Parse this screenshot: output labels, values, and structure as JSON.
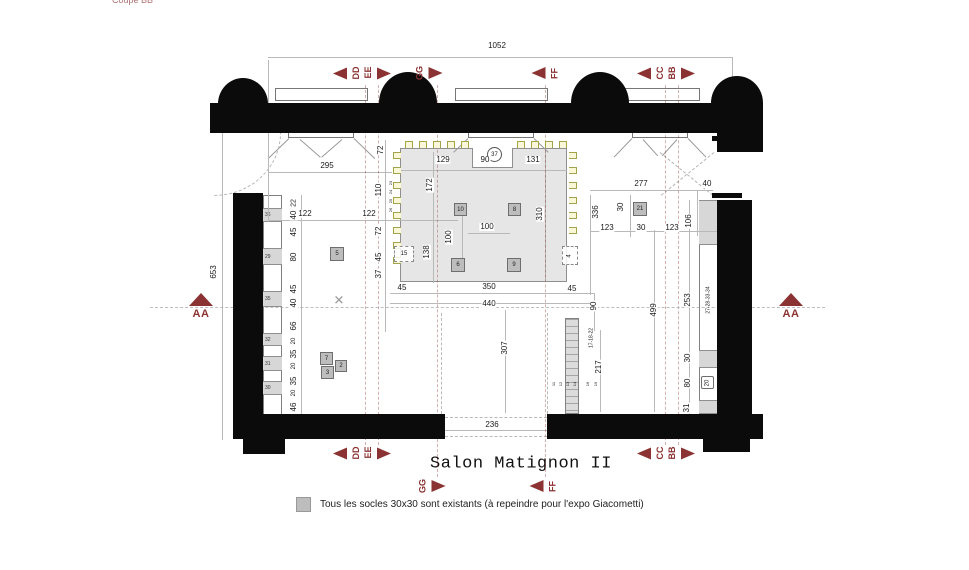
{
  "title": "Salon Matignon II",
  "header": {
    "cut_text": "Coupe BB"
  },
  "legend": {
    "swatch_color": "#bdbdbd",
    "text": "Tous les socles 30x30 sont existants (à repeindre pour l'expo Giacometti)"
  },
  "colors": {
    "marker_red": "#8b3232",
    "wall": "#0b0b0b",
    "platform": "#e6e6e6",
    "pedestal": "#bdbdbd",
    "chair": "#a3a34a"
  },
  "sections": [
    {
      "texts": [
        "DD",
        "EE"
      ],
      "x": 362,
      "y": 73,
      "left": true,
      "right": true
    },
    {
      "texts": [
        "GG"
      ],
      "x": 428,
      "y": 73,
      "left": false,
      "right": true
    },
    {
      "texts": [
        "FF"
      ],
      "x": 546,
      "y": 73,
      "left": true,
      "right": false
    },
    {
      "texts": [
        "CC",
        "BB"
      ],
      "x": 666,
      "y": 73,
      "left": true,
      "right": true
    },
    {
      "texts": [
        "DD",
        "EE"
      ],
      "x": 362,
      "y": 453,
      "left": true,
      "right": true
    },
    {
      "texts": [
        "CC",
        "BB"
      ],
      "x": 666,
      "y": 453,
      "left": true,
      "right": true
    },
    {
      "texts": [
        "GG"
      ],
      "x": 431,
      "y": 486,
      "left": false,
      "right": true
    },
    {
      "texts": [
        "FF"
      ],
      "x": 544,
      "y": 486,
      "left": true,
      "right": false
    }
  ],
  "aa_markers": [
    {
      "label": "AA",
      "x": 201,
      "y": 293
    },
    {
      "label": "AA",
      "x": 791,
      "y": 293
    }
  ],
  "circle_labels": [
    {
      "n": "37",
      "x": 494,
      "y": 154
    }
  ],
  "boxes": [
    {
      "n": "10",
      "x": 454,
      "y": 203,
      "s": 13
    },
    {
      "n": "8",
      "x": 508,
      "y": 203,
      "s": 13
    },
    {
      "n": "6",
      "x": 451,
      "y": 258,
      "s": 14
    },
    {
      "n": "9",
      "x": 507,
      "y": 258,
      "s": 14
    },
    {
      "n": "5",
      "x": 330,
      "y": 247,
      "s": 14
    },
    {
      "n": "21",
      "x": 633,
      "y": 202,
      "s": 14
    },
    {
      "n": "7",
      "x": 320,
      "y": 352,
      "s": 13
    },
    {
      "n": "2",
      "x": 335,
      "y": 360,
      "s": 12
    },
    {
      "n": "3",
      "x": 321,
      "y": 366,
      "s": 13
    },
    {
      "n": "20",
      "x": 701,
      "y": 376,
      "s": 13,
      "white": true,
      "rot": true
    }
  ],
  "dashed_boxes": [
    {
      "n": "15",
      "x": 394,
      "y": 246,
      "w": 20,
      "h": 16
    },
    {
      "n": "4",
      "x": 562,
      "y": 246,
      "w": 16,
      "h": 19,
      "rot": true
    }
  ],
  "strip_left": {
    "x": 263,
    "y": 195,
    "w": 19,
    "h": 221,
    "segments": [
      {
        "n": "36",
        "y": 208,
        "h": 14
      },
      {
        "n": "29",
        "y": 248,
        "h": 17
      },
      {
        "n": "35",
        "y": 291,
        "h": 16
      },
      {
        "n": "32",
        "y": 333,
        "h": 13
      },
      {
        "n": "31",
        "y": 356,
        "h": 15
      },
      {
        "n": "30",
        "y": 381,
        "h": 14
      }
    ]
  },
  "strip_right": {
    "x": 699,
    "y": 200,
    "w": 19,
    "h": 215,
    "segments": [
      {
        "n": "",
        "y": 200,
        "h": 45
      },
      {
        "n": "",
        "y": 350,
        "h": 18
      },
      {
        "n": "",
        "y": 400,
        "h": 14
      }
    ]
  },
  "strip_bottom": {
    "x": 565,
    "y": 318,
    "w": 14,
    "h": 96
  },
  "chairs": [
    {
      "x": 405,
      "y": 141,
      "o": "d"
    },
    {
      "x": 419,
      "y": 141,
      "o": "d"
    },
    {
      "x": 433,
      "y": 141,
      "o": "d"
    },
    {
      "x": 447,
      "y": 141,
      "o": "d"
    },
    {
      "x": 461,
      "y": 141,
      "o": "d"
    },
    {
      "x": 517,
      "y": 141,
      "o": "d"
    },
    {
      "x": 531,
      "y": 141,
      "o": "d"
    },
    {
      "x": 545,
      "y": 141,
      "o": "d"
    },
    {
      "x": 559,
      "y": 141,
      "o": "d"
    },
    {
      "x": 393,
      "y": 152,
      "o": "r"
    },
    {
      "x": 393,
      "y": 167,
      "o": "r"
    },
    {
      "x": 393,
      "y": 182,
      "o": "r"
    },
    {
      "x": 393,
      "y": 197,
      "o": "r"
    },
    {
      "x": 393,
      "y": 212,
      "o": "r"
    },
    {
      "x": 393,
      "y": 227,
      "o": "r"
    },
    {
      "x": 393,
      "y": 242,
      "o": "r"
    },
    {
      "x": 393,
      "y": 257,
      "o": "r"
    },
    {
      "x": 569,
      "y": 152,
      "o": "l"
    },
    {
      "x": 569,
      "y": 167,
      "o": "l"
    },
    {
      "x": 569,
      "y": 182,
      "o": "l"
    },
    {
      "x": 569,
      "y": 197,
      "o": "l"
    },
    {
      "x": 569,
      "y": 212,
      "o": "l"
    },
    {
      "x": 569,
      "y": 227,
      "o": "l"
    }
  ],
  "labels": [
    {
      "t": "1052",
      "x": 497,
      "y": 46
    },
    {
      "t": "295",
      "x": 327,
      "y": 166
    },
    {
      "t": "72",
      "x": 381,
      "y": 150,
      "r": 1
    },
    {
      "t": "110",
      "x": 379,
      "y": 190,
      "r": 1
    },
    {
      "t": "129",
      "x": 443,
      "y": 160
    },
    {
      "t": "90",
      "x": 485,
      "y": 160
    },
    {
      "t": "131",
      "x": 533,
      "y": 160
    },
    {
      "t": "172",
      "x": 430,
      "y": 185,
      "r": 1
    },
    {
      "t": "122",
      "x": 305,
      "y": 214
    },
    {
      "t": "122",
      "x": 369,
      "y": 214
    },
    {
      "t": "72",
      "x": 379,
      "y": 231,
      "r": 1
    },
    {
      "t": "45",
      "x": 379,
      "y": 257,
      "r": 1
    },
    {
      "t": "37",
      "x": 379,
      "y": 274,
      "r": 1
    },
    {
      "t": "138",
      "x": 427,
      "y": 252,
      "r": 1
    },
    {
      "t": "100",
      "x": 487,
      "y": 227
    },
    {
      "t": "100",
      "x": 449,
      "y": 237,
      "r": 1
    },
    {
      "t": "310",
      "x": 540,
      "y": 214,
      "r": 1
    },
    {
      "t": "336",
      "x": 596,
      "y": 212,
      "r": 1
    },
    {
      "t": "30",
      "x": 621,
      "y": 207,
      "r": 1
    },
    {
      "t": "277",
      "x": 641,
      "y": 184
    },
    {
      "t": "40",
      "x": 707,
      "y": 184
    },
    {
      "t": "123",
      "x": 607,
      "y": 228
    },
    {
      "t": "30",
      "x": 641,
      "y": 228
    },
    {
      "t": "123",
      "x": 672,
      "y": 228
    },
    {
      "t": "106",
      "x": 689,
      "y": 221,
      "r": 1
    },
    {
      "t": "45",
      "x": 402,
      "y": 288
    },
    {
      "t": "350",
      "x": 489,
      "y": 287
    },
    {
      "t": "45",
      "x": 572,
      "y": 289
    },
    {
      "t": "440",
      "x": 489,
      "y": 304
    },
    {
      "t": "90",
      "x": 594,
      "y": 306,
      "r": 1
    },
    {
      "t": "307",
      "x": 505,
      "y": 348,
      "r": 1
    },
    {
      "t": "499",
      "x": 654,
      "y": 310,
      "r": 1
    },
    {
      "t": "253",
      "x": 688,
      "y": 300,
      "r": 1
    },
    {
      "t": "27-28-33-34",
      "x": 709,
      "y": 300,
      "r": 1,
      "fs": 5
    },
    {
      "t": "17-18-22",
      "x": 592,
      "y": 338,
      "r": 1,
      "fs": 5
    },
    {
      "t": "217",
      "x": 599,
      "y": 367,
      "r": 1
    },
    {
      "t": "30",
      "x": 688,
      "y": 358,
      "r": 1
    },
    {
      "t": "80",
      "x": 688,
      "y": 383,
      "r": 1
    },
    {
      "t": "31",
      "x": 687,
      "y": 408,
      "r": 1
    },
    {
      "t": "236",
      "x": 492,
      "y": 425
    },
    {
      "t": "653",
      "x": 214,
      "y": 272,
      "r": 1
    },
    {
      "t": "22",
      "x": 294,
      "y": 203,
      "r": 1,
      "fs": 7
    },
    {
      "t": "40",
      "x": 294,
      "y": 215,
      "r": 1
    },
    {
      "t": "45",
      "x": 294,
      "y": 232,
      "r": 1
    },
    {
      "t": "80",
      "x": 294,
      "y": 257,
      "r": 1
    },
    {
      "t": "45",
      "x": 294,
      "y": 289,
      "r": 1
    },
    {
      "t": "40",
      "x": 294,
      "y": 303,
      "r": 1
    },
    {
      "t": "66",
      "x": 294,
      "y": 326,
      "r": 1
    },
    {
      "t": "20",
      "x": 294,
      "y": 341,
      "r": 1,
      "fs": 6
    },
    {
      "t": "35",
      "x": 294,
      "y": 354,
      "r": 1
    },
    {
      "t": "20",
      "x": 294,
      "y": 366,
      "r": 1,
      "fs": 6
    },
    {
      "t": "35",
      "x": 294,
      "y": 381,
      "r": 1
    },
    {
      "t": "20",
      "x": 294,
      "y": 393,
      "r": 1,
      "fs": 6
    },
    {
      "t": "46",
      "x": 294,
      "y": 407,
      "r": 1
    },
    {
      "t": "23",
      "x": 391,
      "y": 183,
      "r": 1,
      "fs": 4
    },
    {
      "t": "24",
      "x": 391,
      "y": 192,
      "r": 1,
      "fs": 4
    },
    {
      "t": "25",
      "x": 391,
      "y": 201,
      "r": 1,
      "fs": 4
    },
    {
      "t": "26",
      "x": 391,
      "y": 210,
      "r": 1,
      "fs": 4
    },
    {
      "t": "11",
      "x": 554,
      "y": 384,
      "r": 1,
      "fs": 4
    },
    {
      "t": "12",
      "x": 561,
      "y": 384,
      "r": 1,
      "fs": 4
    },
    {
      "t": "13",
      "x": 568,
      "y": 384,
      "r": 1,
      "fs": 4
    },
    {
      "t": "14",
      "x": 575,
      "y": 384,
      "r": 1,
      "fs": 4
    },
    {
      "t": "16",
      "x": 588,
      "y": 384,
      "r": 1,
      "fs": 4
    },
    {
      "t": "19",
      "x": 596,
      "y": 384,
      "r": 1,
      "fs": 4
    },
    {
      "t": "✕",
      "x": 339,
      "y": 300,
      "fs": 13,
      "c": "#999"
    }
  ]
}
